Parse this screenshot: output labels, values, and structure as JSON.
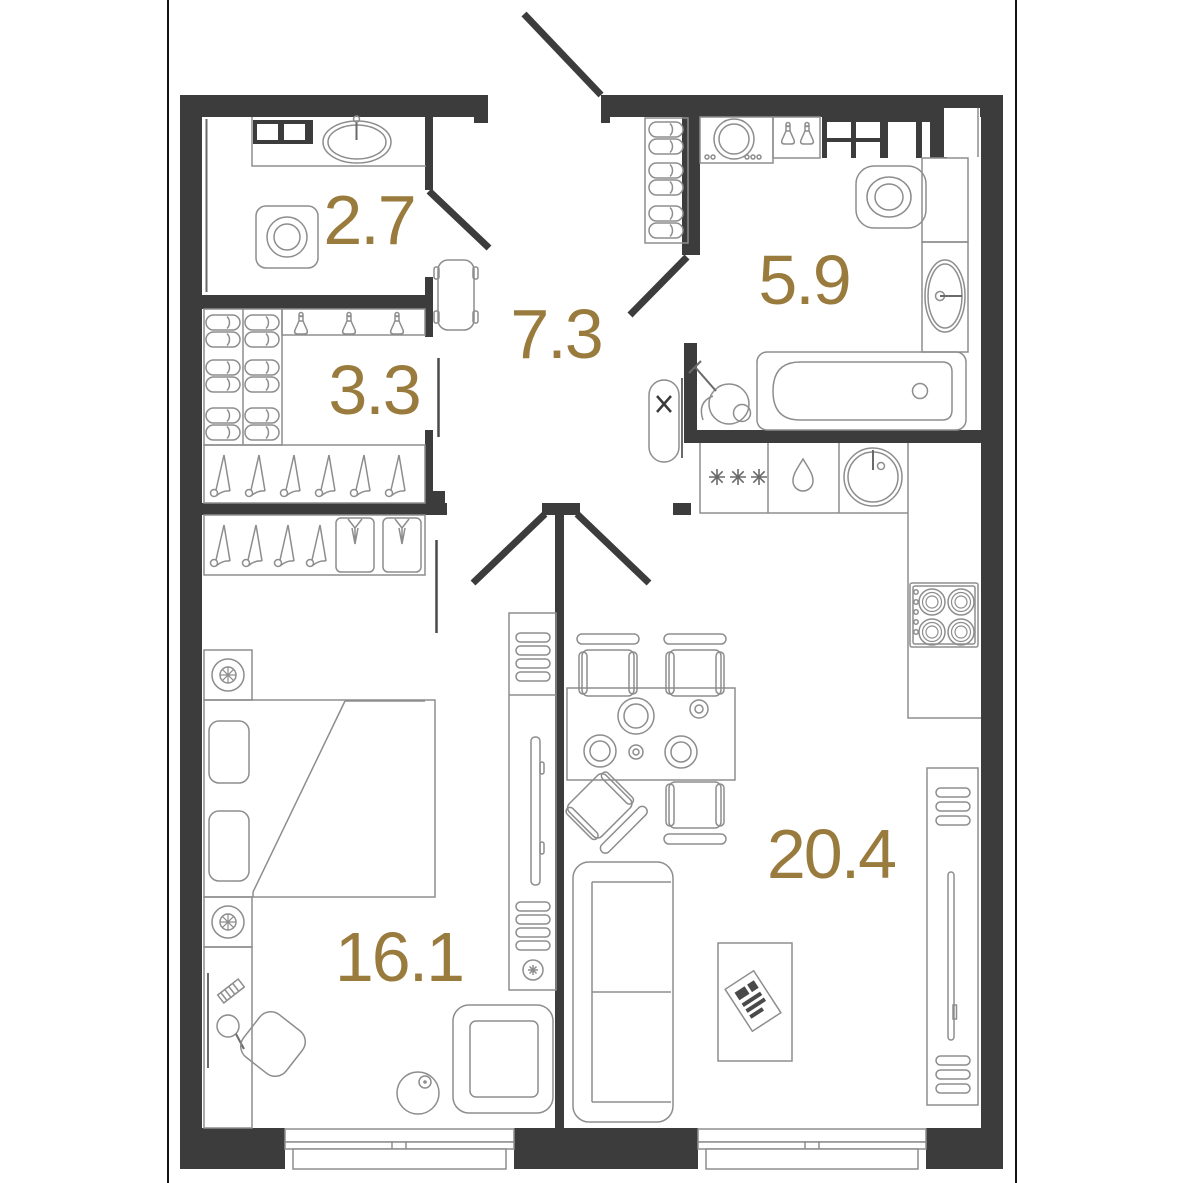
{
  "plan": {
    "type": "apartment-floor-plan",
    "units": "m2",
    "rooms": [
      {
        "name": "bathroom-small",
        "label": "2.7"
      },
      {
        "name": "wardrobe",
        "label": "3.3"
      },
      {
        "name": "hallway",
        "label": "7.3"
      },
      {
        "name": "bathroom",
        "label": "5.9"
      },
      {
        "name": "bedroom",
        "label": "16.1"
      },
      {
        "name": "living-kitchen",
        "label": "20.4"
      }
    ],
    "furniture_visible": {
      "bathroom-small": [
        "counter with sink",
        "shelf",
        "washing machine"
      ],
      "wardrobe": [
        "shoe shelves",
        "spray bottles",
        "hanger rod"
      ],
      "hallway": [
        "entrance door",
        "bench",
        "shoe rack",
        "ironing board"
      ],
      "bathroom": [
        "washing machine",
        "spray bottles",
        "vent shaft",
        "toilet",
        "sink vanity",
        "bathtub",
        "vacuum cleaner"
      ],
      "bedroom": [
        "closet with hangers and shirts",
        "nightstands",
        "double bed",
        "dressing table",
        "chair",
        "armchair",
        "floor lamp",
        "tv console"
      ],
      "living-kitchen": [
        "kitchen counter",
        "dryer",
        "dishwasher",
        "round sink",
        "stove",
        "tall cabinet",
        "dining table",
        "4 chairs",
        "sofa",
        "coffee table with magazine"
      ]
    },
    "windows_on_bottom_wall": 2
  },
  "colors": {
    "wall": "#3c3c3c",
    "room_label": "#9a7b3e",
    "furniture_line": "#8d8d8d",
    "detail_line": "#6a6a6a",
    "page_border": "#141414",
    "background": "#ffffff"
  }
}
